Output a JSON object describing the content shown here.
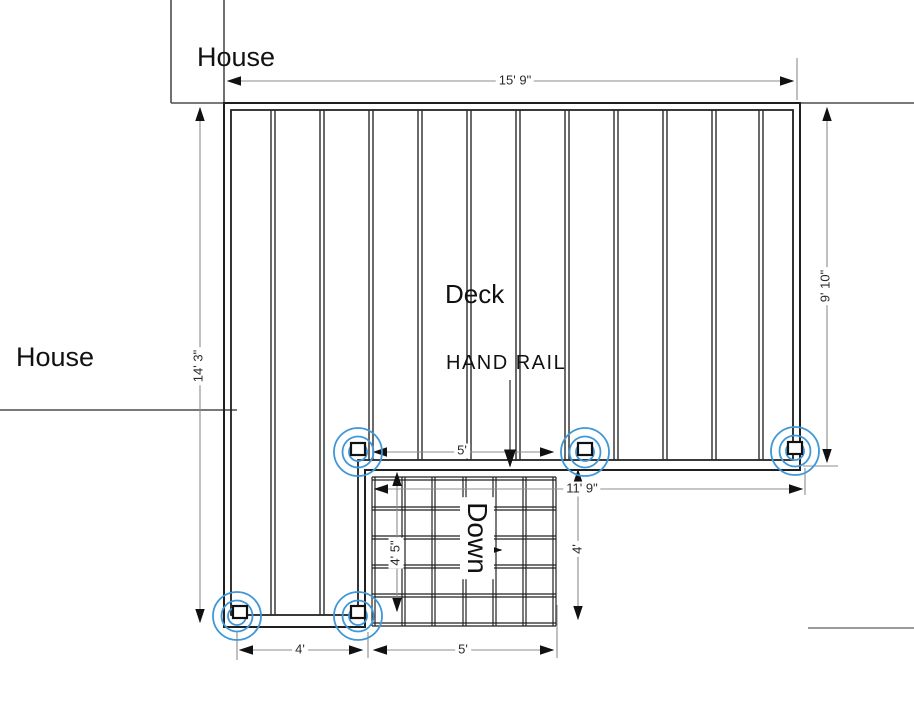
{
  "labels": {
    "house_top": "House",
    "house_left": "House",
    "deck": "Deck",
    "hand_rail": "HAND RAIL",
    "down": "Down"
  },
  "dimensions": {
    "top_width": "15' 9\"",
    "right_height": "9' 10\"",
    "left_height": "14' 3\"",
    "stair_top_width": "5'",
    "lower_width": "11' 9\"",
    "stair_side_height": "4' 5\"",
    "stair_right_height": "4'",
    "footing_spacing": "4'",
    "stair_bottom_width": "5'"
  },
  "colors": {
    "footing_blue": "#3f97d8",
    "dim_gray": "#8c8c8c",
    "line_dark": "#1f1f1f"
  }
}
